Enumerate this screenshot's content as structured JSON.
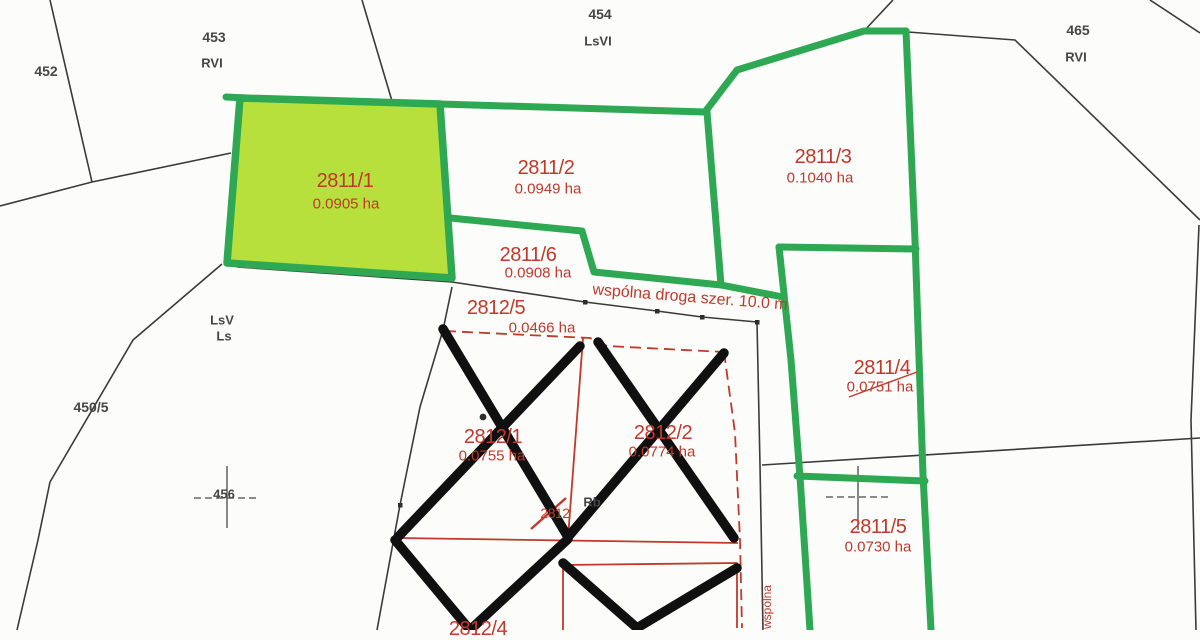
{
  "map": {
    "canvas": {
      "width": 1200,
      "height": 630
    },
    "colors": {
      "boundary_green": "#2ea853",
      "highlight_fill": "#b7e03c",
      "annotation_red": "#c0392b",
      "line_black": "#3a3a3a",
      "cross_black": "#101010"
    },
    "highlighted_parcel": "2811/1",
    "parcels": [
      {
        "id": "2811/1",
        "area": "0.0905 ha"
      },
      {
        "id": "2811/2",
        "area": "0.0949 ha"
      },
      {
        "id": "2811/3",
        "area": "0.1040 ha"
      },
      {
        "id": "2811/6",
        "area": "0.0908 ha"
      },
      {
        "id": "2811/4",
        "area": "0.0751 ha"
      },
      {
        "id": "2811/5",
        "area": "0.0730 ha"
      },
      {
        "id": "2812/5",
        "area": "0.0466 ha"
      },
      {
        "id": "2812/1",
        "area": "0.0755 ha"
      },
      {
        "id": "2812/2",
        "area": "0.0774 ha"
      },
      {
        "id": "2812/4",
        "area": ""
      }
    ],
    "neighbor_parcels": [
      {
        "id": "452",
        "land_class": ""
      },
      {
        "id": "453",
        "land_class": "RVI"
      },
      {
        "id": "454",
        "land_class": "LsVI"
      },
      {
        "id": "465",
        "land_class": "RVI"
      },
      {
        "id": "450/5",
        "land_class": ""
      },
      {
        "id": "456",
        "land_class": ""
      }
    ],
    "land_class_labels": {
      "lsv": "LsV",
      "ls": "Ls",
      "rb": "Rb"
    },
    "road_label": "wspólna droga szer. 10.0 m",
    "road_label_vertical": "wspólna",
    "struck_parcel_number": "2812"
  }
}
